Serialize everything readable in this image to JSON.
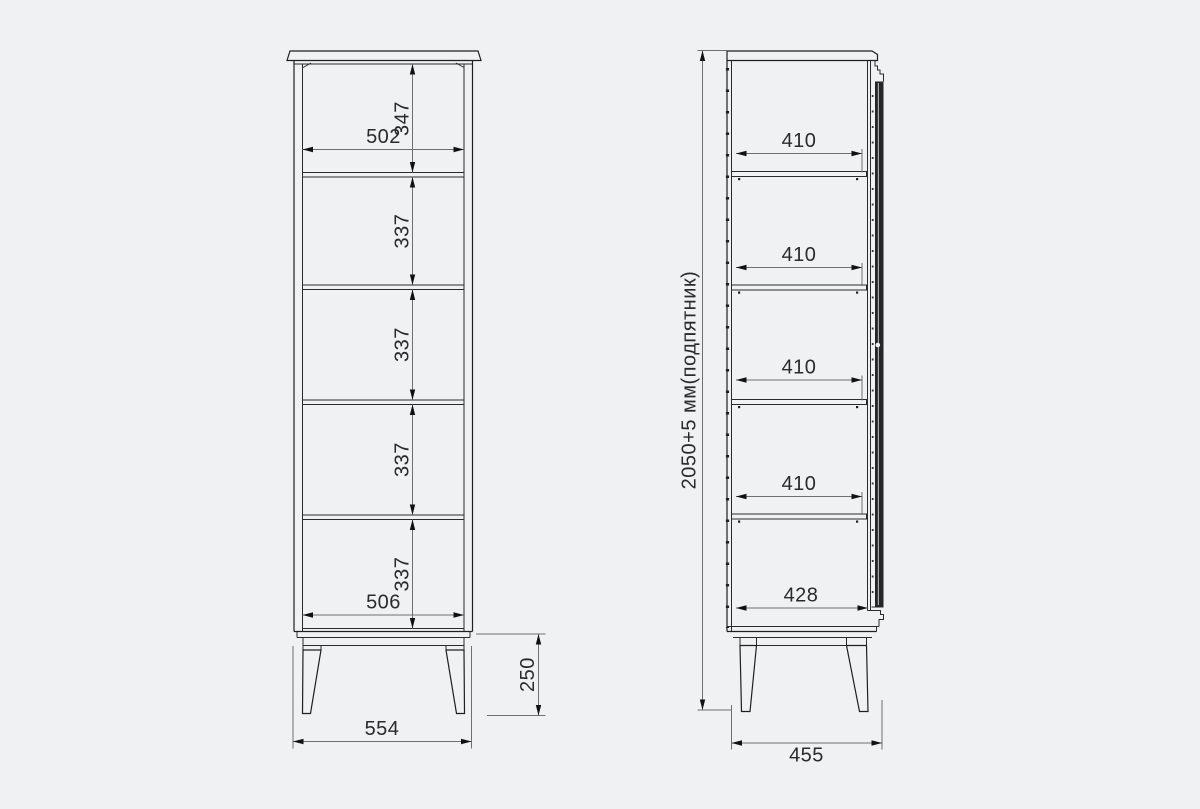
{
  "drawing_title": "cabinet-dimension-drawing",
  "colors": {
    "background": "#f0f1f2",
    "object_line": "#1f1f1f",
    "dimension_line": "#6f6f6f",
    "text": "#2a2a2a",
    "door_fill": "#262626"
  },
  "front_view": {
    "top_section_height": "347",
    "top_inner_width": "502",
    "section_heights": [
      "337",
      "337",
      "337",
      "337"
    ],
    "bottom_inner_width": "506",
    "overall_width": "554",
    "leg_height": "250"
  },
  "side_view": {
    "overall_height": "2050+5 мм(подпятник)",
    "shelf_depths": [
      "410",
      "410",
      "410",
      "410"
    ],
    "bottom_depth": "428",
    "overall_depth": "455"
  }
}
